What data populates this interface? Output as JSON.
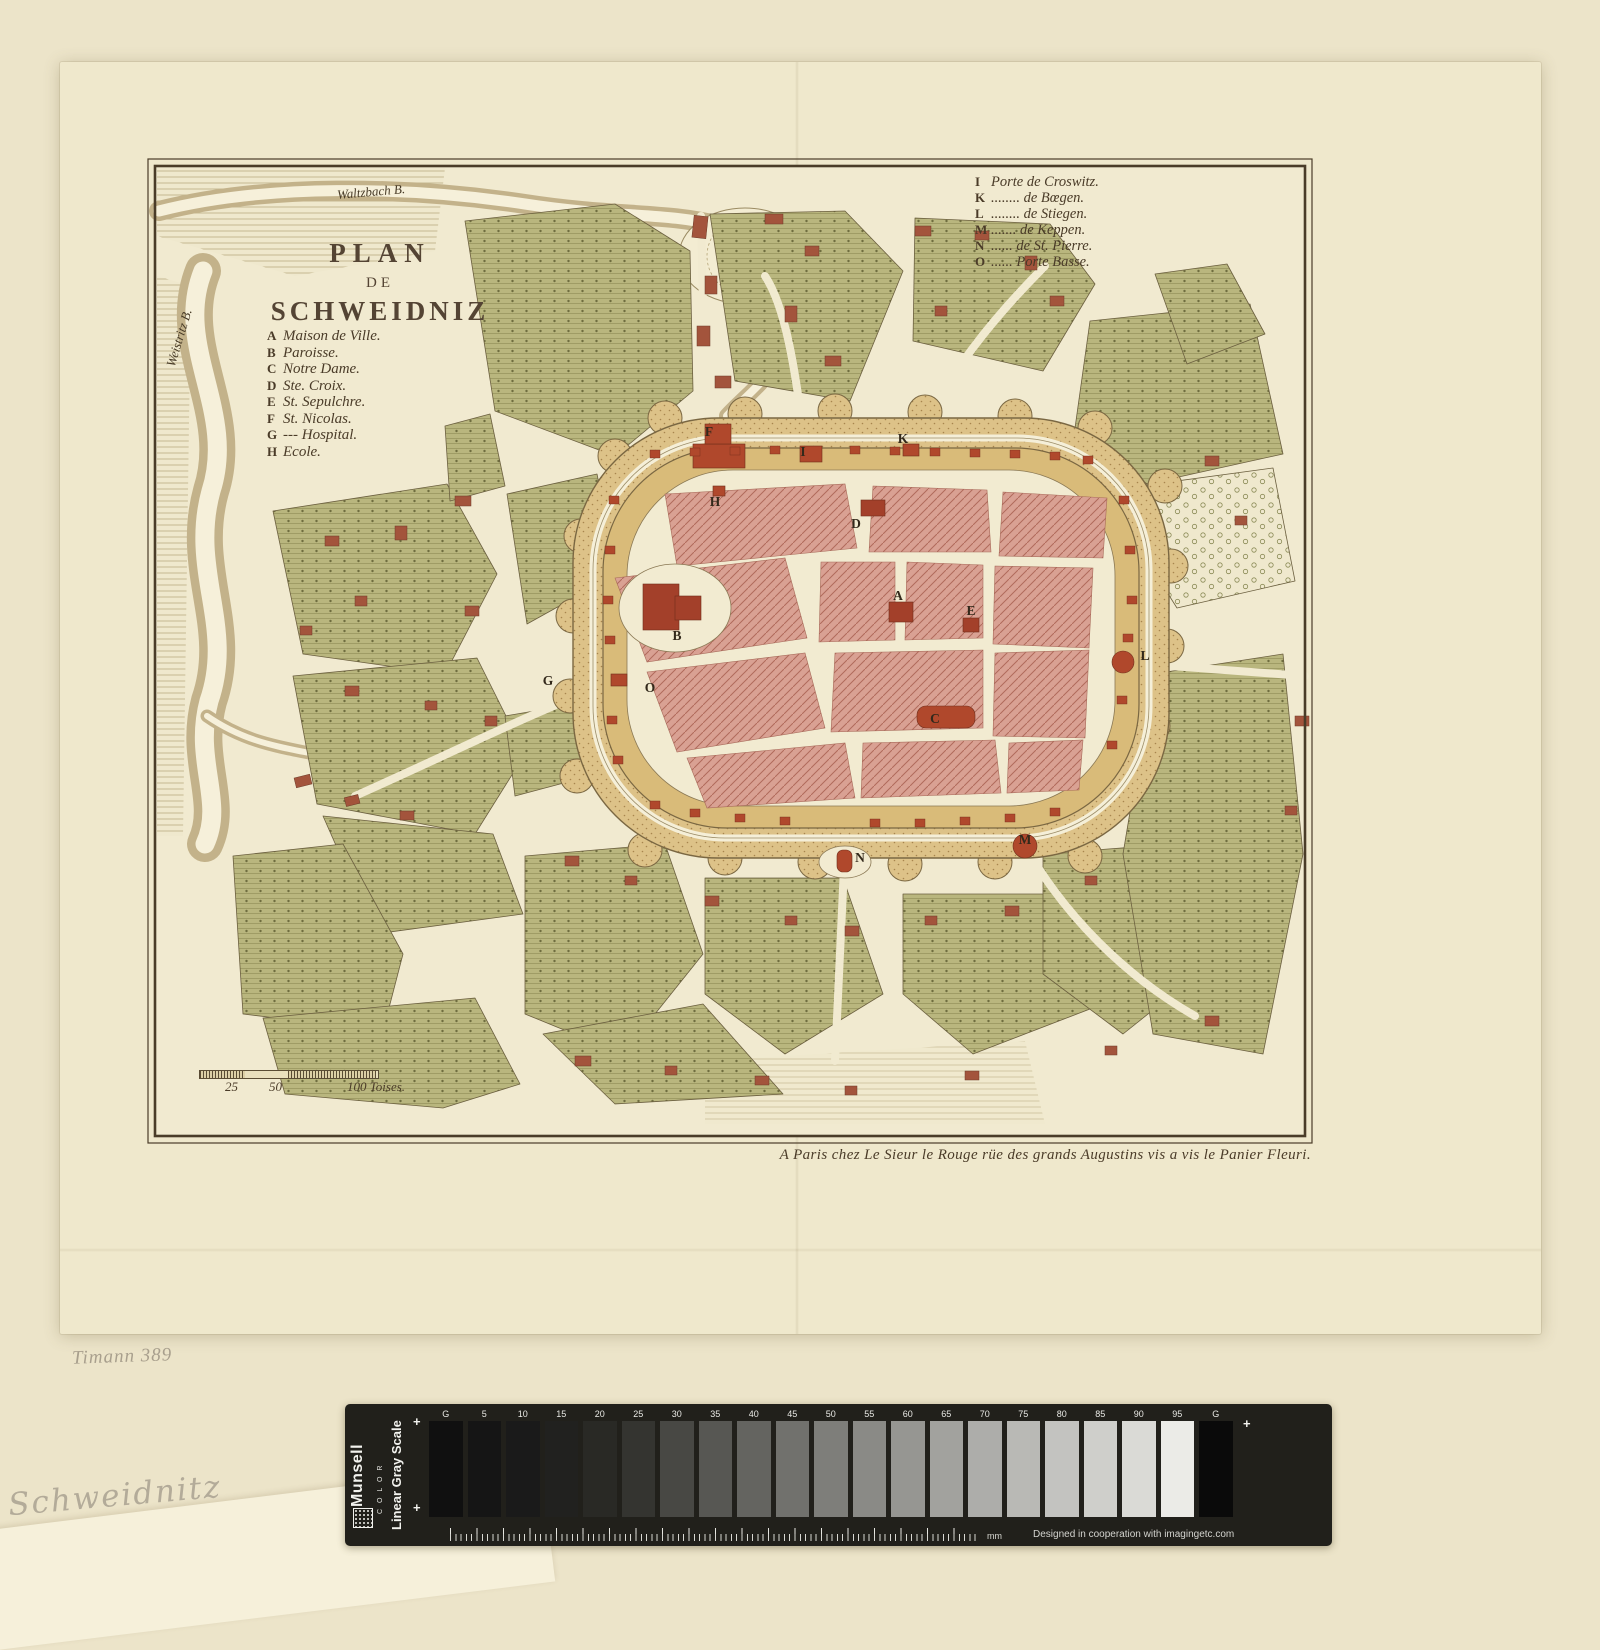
{
  "map": {
    "title_lines": [
      "PLAN",
      "DE",
      "SCHWEIDNIZ"
    ],
    "legend_buildings": [
      {
        "key": "A",
        "label": "Maison de Ville."
      },
      {
        "key": "B",
        "label": "Paroisse."
      },
      {
        "key": "C",
        "label": "Notre Dame."
      },
      {
        "key": "D",
        "label": "Ste. Croix."
      },
      {
        "key": "E",
        "label": "St. Sepulchre."
      },
      {
        "key": "F",
        "label": "St. Nicolas."
      },
      {
        "key": "G",
        "label": "--- Hospital."
      },
      {
        "key": "H",
        "label": "Ecole."
      }
    ],
    "legend_gates": [
      {
        "key": "I",
        "label": "Porte de Croswitz."
      },
      {
        "key": "K",
        "label": "........ de Bœgen."
      },
      {
        "key": "L",
        "label": "........ de Stiegen."
      },
      {
        "key": "M",
        "label": "....... de Keppen."
      },
      {
        "key": "N",
        "label": "...... de St. Pierre."
      },
      {
        "key": "O",
        "label": "...... Porte Basse."
      }
    ],
    "river_labels": {
      "top": "Waltzbach B.",
      "left": "Weistritz B."
    },
    "scale_bar": {
      "tick1": "25",
      "tick2": "50",
      "end": "100 Toises."
    },
    "imprint": "A Paris chez Le Sieur le Rouge rüe des grands Augustins vis a vis le Panier Fleuri.",
    "letters": [
      "F",
      "I",
      "K",
      "H",
      "D",
      "B",
      "A",
      "E",
      "G",
      "O",
      "L",
      "C",
      "N",
      "M"
    ]
  },
  "annotations": {
    "catalog_number": "Timann 389",
    "pencil_title": "Schweidnitz"
  },
  "grayscale_bar": {
    "brand": "Munsell",
    "brand_sub": "C O L O R",
    "scale_label": "Linear Gray Scale",
    "plus": "+",
    "unit": "mm",
    "credit": "Designed in cooperation with imagingetc.com",
    "patch_labels": [
      "G",
      "5",
      "10",
      "15",
      "20",
      "25",
      "30",
      "35",
      "40",
      "45",
      "50",
      "55",
      "60",
      "65",
      "70",
      "75",
      "80",
      "85",
      "90",
      "95",
      "G"
    ],
    "patch_colors": [
      "#101010",
      "#151515",
      "#1a1a1a",
      "#21211f",
      "#292925",
      "#343430",
      "#484844",
      "#575753",
      "#646460",
      "#71716d",
      "#7e7e7a",
      "#8a8a86",
      "#969692",
      "#a2a29e",
      "#adadaa",
      "#b9b9b5",
      "#c3c3c0",
      "#cfcfcb",
      "#dadad6",
      "#ebebe7",
      "#0a0a0a"
    ]
  },
  "colors": {
    "backdrop": "#ece4c9",
    "sheet_paper": "#efe8cc",
    "plate_paper": "#f1ead0",
    "engraving_ink": "#4a3c28",
    "building_red": "#a3402a",
    "block_pink": "#d9a193",
    "garden_green": "#b9b67e",
    "glacis_tan": "#ddc288",
    "bar_background": "#21201b"
  }
}
